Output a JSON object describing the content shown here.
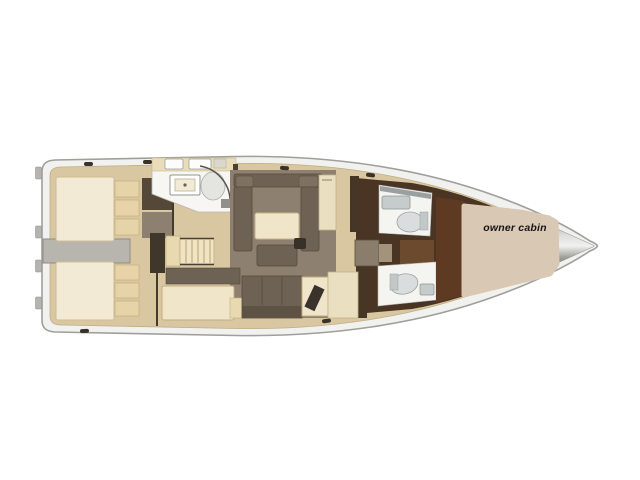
{
  "annotation": {
    "owner_cabin_label": "owner cabin"
  },
  "colors": {
    "background": "#ffffff",
    "hull_fill": "#f1f1ef",
    "hull_outline": "#a09f9a",
    "floor_tan": "#d8c7a0",
    "floor_edge": "#bfae85",
    "bed_cream": "#f3ead5",
    "cushion_tan": "#e6d3a8",
    "sofa_taupe": "#6e6254",
    "salon_floor": "#8d8070",
    "walkway_gray": "#b8b5ae",
    "wall_dark": "#463a2a",
    "galley_white": "#f7f6f3",
    "counter_cream": "#e9dcb8",
    "stairs_cream": "#f0e4c2",
    "forward_floor_brown": "#4a3423",
    "owner_redbrown": "#5f3a22",
    "head_white": "#f4f4f1",
    "fixture_gray": "#c6cbcb",
    "window_gray": "#9aa0a0",
    "bow_gray": "#6b6b66",
    "overlay_beige": "#d9c8b3",
    "label_text": "#161616"
  }
}
